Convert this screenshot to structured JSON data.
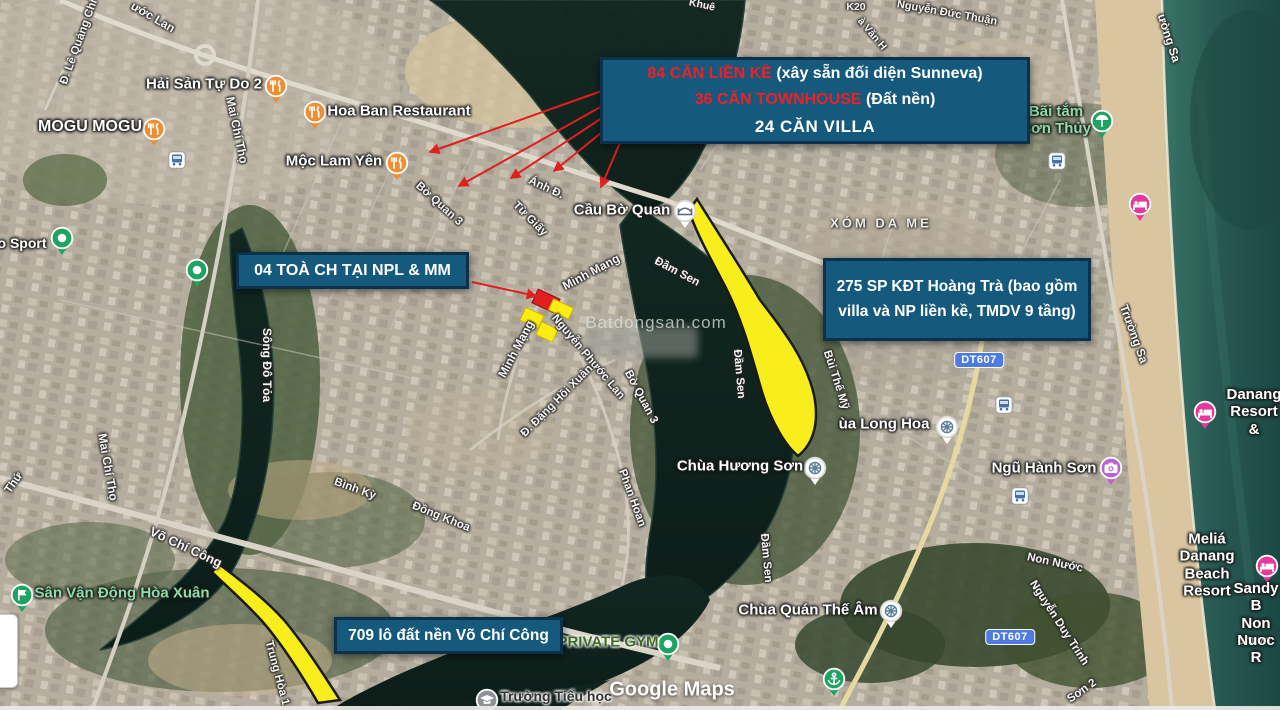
{
  "callouts": {
    "top": {
      "line1_red": "84 CĂN LIỀN KỀ",
      "line1_rest": " (xây sẵn đối diện Sunneva)",
      "line2_red": "36 CĂN TOWNHOUSE",
      "line2_rest": " (Đất nền)",
      "line3": "24 CĂN VILLA"
    },
    "npl": {
      "text": "04 TOÀ CH TẠI NPL & MM"
    },
    "hoangtra": {
      "line1": "275 SP KĐT Hoàng Trà (bao gồm",
      "line2": "villa và NP liền kề, TMDV 9 tầng)"
    },
    "vochicong": {
      "text": "709 lô đất nền Võ Chí Công"
    }
  },
  "watermarks": {
    "center": "Batdongsan.com",
    "maps": "Google Maps",
    "corner": "om.vn"
  },
  "colors": {
    "callout_bg": "#15597d",
    "callout_border": "#0b314d",
    "callout_red_text": "#ef1f27",
    "highlight_yellow": "#f8ee1b",
    "arrow_red": "#e01f1f",
    "badge_blue": "#4f7be0",
    "ocean_teal": "#24564e",
    "river_dark": "#0e211b"
  },
  "badges": [
    {
      "text": "DT607",
      "x": 979,
      "y": 360
    },
    {
      "text": "DT607",
      "x": 1010,
      "y": 637
    }
  ],
  "area_labels": [
    {
      "text": "XÓM DA ME",
      "x": 881,
      "y": 223,
      "fs": 13
    }
  ],
  "pois": [
    {
      "text": "Hải Sản Tự Do 2",
      "icon": "restaurant",
      "x": 276,
      "y": 86,
      "lx": 204,
      "ly": 84,
      "color": "white",
      "fs": 15
    },
    {
      "text": "MOGU MOGU",
      "icon": "restaurant",
      "x": 154,
      "y": 129,
      "lx": 90,
      "ly": 127,
      "color": "white",
      "fs": 16
    },
    {
      "text": "Hoa Ban Restaurant",
      "icon": "restaurant",
      "x": 315,
      "y": 112,
      "lx": 399,
      "ly": 111,
      "color": "white",
      "fs": 15
    },
    {
      "text": "Mộc Lam Yên",
      "icon": "restaurant",
      "x": 397,
      "y": 163,
      "lx": 334,
      "ly": 161,
      "color": "white",
      "fs": 15
    },
    {
      "text": "o Sport",
      "icon": "pin",
      "x": 62,
      "y": 238,
      "lx": 22,
      "ly": 243,
      "color": "white",
      "fs": 14
    },
    {
      "text": "",
      "icon": "pin",
      "x": 197,
      "y": 270,
      "lx": 0,
      "ly": 0,
      "color": "white",
      "fs": 14
    },
    {
      "text": "Cầu Bờ Quan",
      "icon": "bridge",
      "x": 685,
      "y": 211,
      "lx": 622,
      "ly": 210,
      "color": "white",
      "fs": 15
    },
    {
      "text": "Bãi tắm\nSơn Thủy",
      "icon": "beach",
      "x": 1102,
      "y": 121,
      "lx": 1056,
      "ly": 120,
      "color": "green",
      "fs": 15
    },
    {
      "text": "",
      "icon": "hotel",
      "x": 1140,
      "y": 204,
      "lx": 0,
      "ly": 0,
      "color": "white",
      "fs": 14
    },
    {
      "text": "ùa Long Hoa",
      "icon": "dharma",
      "x": 947,
      "y": 427,
      "lx": 884,
      "ly": 424,
      "color": "white",
      "fs": 15
    },
    {
      "text": "Chùa Hương Sơn",
      "icon": "dharma",
      "x": 815,
      "y": 468,
      "lx": 740,
      "ly": 466,
      "color": "white",
      "fs": 15
    },
    {
      "text": "Ngũ Hành Sơn",
      "icon": "camera",
      "x": 1111,
      "y": 468,
      "lx": 1044,
      "ly": 468,
      "color": "white",
      "fs": 15
    },
    {
      "text": "Chùa Quán Thế Âm",
      "icon": "dharma",
      "x": 891,
      "y": 611,
      "lx": 808,
      "ly": 610,
      "color": "white",
      "fs": 15
    },
    {
      "text": "",
      "icon": "harbor",
      "x": 834,
      "y": 679,
      "lx": 0,
      "ly": 0,
      "color": "white",
      "fs": 14
    },
    {
      "text": "Meliá Danang\nBeach Resort",
      "icon": "hotel",
      "x": 1267,
      "y": 566,
      "lx": 1207,
      "ly": 565,
      "color": "white",
      "fs": 15
    },
    {
      "text": "Sandy B\nNon Nuoc R",
      "icon": "",
      "x": 0,
      "y": 0,
      "lx": 1256,
      "ly": 623,
      "color": "white",
      "fs": 15
    },
    {
      "text": "Danang\nResort &",
      "icon": "hotel",
      "x": 1205,
      "y": 412,
      "lx": 1254,
      "ly": 412,
      "color": "white",
      "fs": 15
    },
    {
      "text": "Sân Vận Động Hòa Xuân",
      "icon": "stadium",
      "x": 22,
      "y": 595,
      "lx": 122,
      "ly": 593,
      "color": "green",
      "fs": 15
    },
    {
      "text": "PRIVATE GYM",
      "icon": "pin",
      "x": 668,
      "y": 644,
      "lx": 608,
      "ly": 642,
      "color": "gym",
      "fs": 15
    },
    {
      "text": "Trường Tiểu học",
      "icon": "school",
      "x": 487,
      "y": 700,
      "lx": 556,
      "ly": 696,
      "color": "dark",
      "fs": 14
    },
    {
      "text": "",
      "icon": "bus",
      "x": 177,
      "y": 160,
      "lx": 0,
      "ly": 0,
      "color": "white",
      "fs": 14
    },
    {
      "text": "",
      "icon": "bus",
      "x": 1057,
      "y": 161,
      "lx": 0,
      "ly": 0,
      "color": "white",
      "fs": 14
    },
    {
      "text": "",
      "icon": "bus",
      "x": 1004,
      "y": 405,
      "lx": 0,
      "ly": 0,
      "color": "white",
      "fs": 14
    },
    {
      "text": "",
      "icon": "bus",
      "x": 1020,
      "y": 496,
      "lx": 0,
      "ly": 0,
      "color": "white",
      "fs": 14
    }
  ],
  "road_labels": [
    {
      "text": "Đ. Lê Quảng Chí",
      "x": 79,
      "y": 42,
      "rot": -70,
      "fs": 11.5
    },
    {
      "text": "ước Lan",
      "x": 153,
      "y": 17,
      "rot": 30,
      "fs": 12
    },
    {
      "text": "Mai Chí Thọ",
      "x": 237,
      "y": 130,
      "rot": 78,
      "fs": 12
    },
    {
      "text": "Mai Chí Thọ",
      "x": 108,
      "y": 467,
      "rot": 80,
      "fs": 12
    },
    {
      "text": "Bờ Quan 3",
      "x": 439,
      "y": 204,
      "rot": 42,
      "fs": 11.5
    },
    {
      "text": "Từ Giấy",
      "x": 530,
      "y": 219,
      "rot": 45,
      "fs": 11.5
    },
    {
      "text": "Ánh Đ.",
      "x": 546,
      "y": 188,
      "rot": 25,
      "fs": 11.5
    },
    {
      "text": "Minh Mạng",
      "x": 591,
      "y": 272,
      "rot": -28,
      "fs": 12
    },
    {
      "text": "Đầm Sen",
      "x": 677,
      "y": 272,
      "rot": 28,
      "fs": 11.5
    },
    {
      "text": "Minh Mạng",
      "x": 516,
      "y": 349,
      "rot": -62,
      "fs": 12
    },
    {
      "text": "Nguyễn Phước Lan",
      "x": 588,
      "y": 357,
      "rot": 50,
      "fs": 11.5
    },
    {
      "text": "Đ. Đặng Hồi Xuân",
      "x": 557,
      "y": 401,
      "rot": -45,
      "fs": 11.5
    },
    {
      "text": "Bờ Quan 3",
      "x": 641,
      "y": 397,
      "rot": 62,
      "fs": 11.5
    },
    {
      "text": "Đầm Sen",
      "x": 739,
      "y": 374,
      "rot": 85,
      "fs": 11.5
    },
    {
      "text": "Phan Hoan",
      "x": 632,
      "y": 498,
      "rot": 70,
      "fs": 11.5
    },
    {
      "text": "Đầm Sen",
      "x": 766,
      "y": 558,
      "rot": 85,
      "fs": 11.5
    },
    {
      "text": "Bùi Thế Mỹ",
      "x": 836,
      "y": 380,
      "rot": 72,
      "fs": 11.5
    },
    {
      "text": "Trường Sa",
      "x": 1134,
      "y": 334,
      "rot": 70,
      "fs": 12
    },
    {
      "text": "ường Sa",
      "x": 1169,
      "y": 38,
      "rot": 72,
      "fs": 12
    },
    {
      "text": "Nguyễn Đức Thuận",
      "x": 947,
      "y": 13,
      "rot": 10,
      "fs": 11
    },
    {
      "text": "K20",
      "x": 856,
      "y": 7,
      "rot": 0,
      "fs": 10.5
    },
    {
      "text": "à Văn H",
      "x": 872,
      "y": 34,
      "rot": 50,
      "fs": 10.5
    },
    {
      "text": "Khuê",
      "x": 702,
      "y": 5,
      "rot": 12,
      "fs": 10.5
    },
    {
      "text": "Võ Chí Công",
      "x": 186,
      "y": 547,
      "rot": 25,
      "fs": 13
    },
    {
      "text": "Trung Hòa 1",
      "x": 277,
      "y": 673,
      "rot": 75,
      "fs": 11.5
    },
    {
      "text": "Bình Kỳ",
      "x": 355,
      "y": 489,
      "rot": 20,
      "fs": 11.5
    },
    {
      "text": "Đồng Khoa",
      "x": 441,
      "y": 517,
      "rot": 22,
      "fs": 11.5
    },
    {
      "text": "Sông Đô Tỏa",
      "x": 267,
      "y": 365,
      "rot": 90,
      "fs": 12
    },
    {
      "text": "Non Nước",
      "x": 1055,
      "y": 563,
      "rot": 12,
      "fs": 11.5
    },
    {
      "text": "Nguyễn Duy Trinh",
      "x": 1059,
      "y": 623,
      "rot": 57,
      "fs": 11.5
    },
    {
      "text": "Sơn 2",
      "x": 1082,
      "y": 691,
      "rot": -35,
      "fs": 11.5
    },
    {
      "text": "Thứ",
      "x": 14,
      "y": 483,
      "rot": -55,
      "fs": 11.5
    }
  ]
}
